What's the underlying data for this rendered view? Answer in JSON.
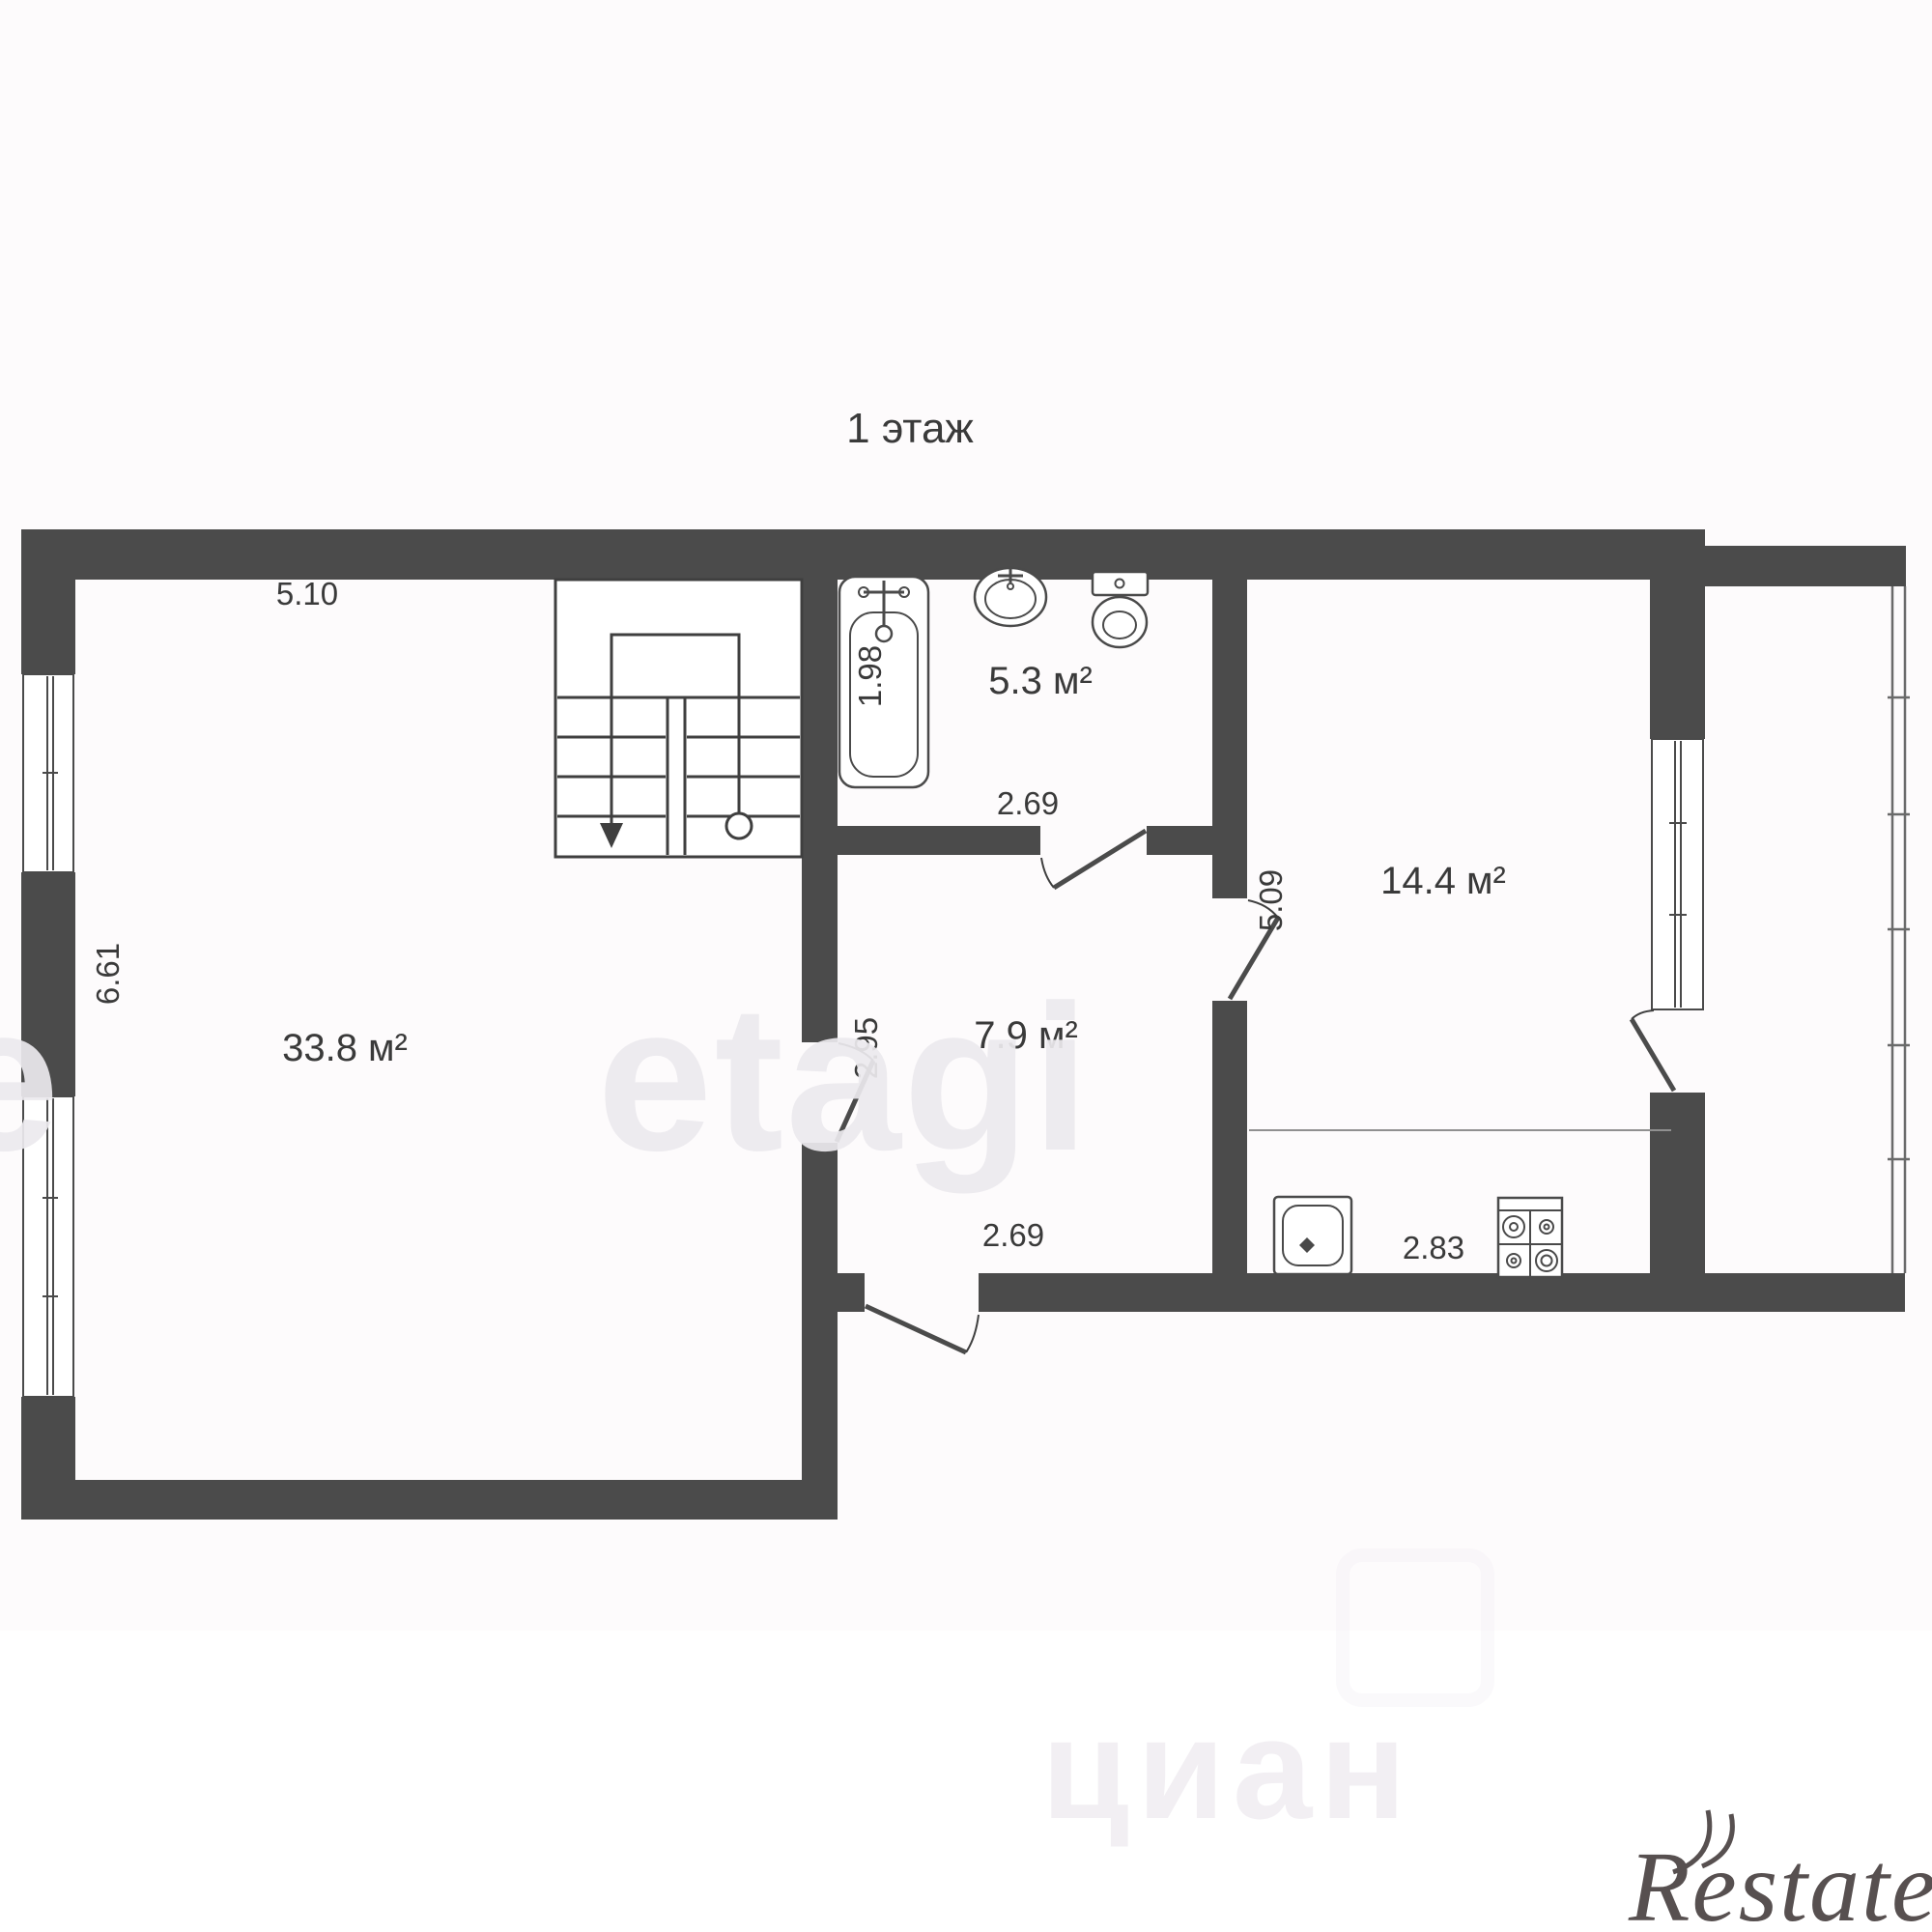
{
  "title": "1 этаж",
  "labels": {
    "area_living": "33.8 м²",
    "area_bath": "5.3 м²",
    "area_hall": "7.9 м²",
    "area_kitchen": "14.4 м²",
    "dim_living_width": "5.10",
    "dim_living_height": "6.61",
    "dim_tub_length": "1.98",
    "dim_bath_width": "2.69",
    "dim_hall_height": "2.95",
    "dim_hall_width": "2.69",
    "dim_kitchen_height": "5.09",
    "dim_kitchen_width": "2.83"
  },
  "watermarks": {
    "etagi": "etagi",
    "etagi_partial": "e",
    "cian": "циан",
    "restate": "Restate"
  },
  "colors": {
    "wall": "#4b4b4b",
    "line": "#3f3f3f",
    "fixture": "#4a4a4a",
    "text": "#3a3a3a",
    "counter_line": "#909090",
    "window_glass": "#6a6a6a",
    "paper": "#fdfbfc",
    "paper_bottom": "#ffffff",
    "watermark_etagi": "#eceaee",
    "watermark_cian": "#f2eff3",
    "logo_restate": "#575050"
  }
}
